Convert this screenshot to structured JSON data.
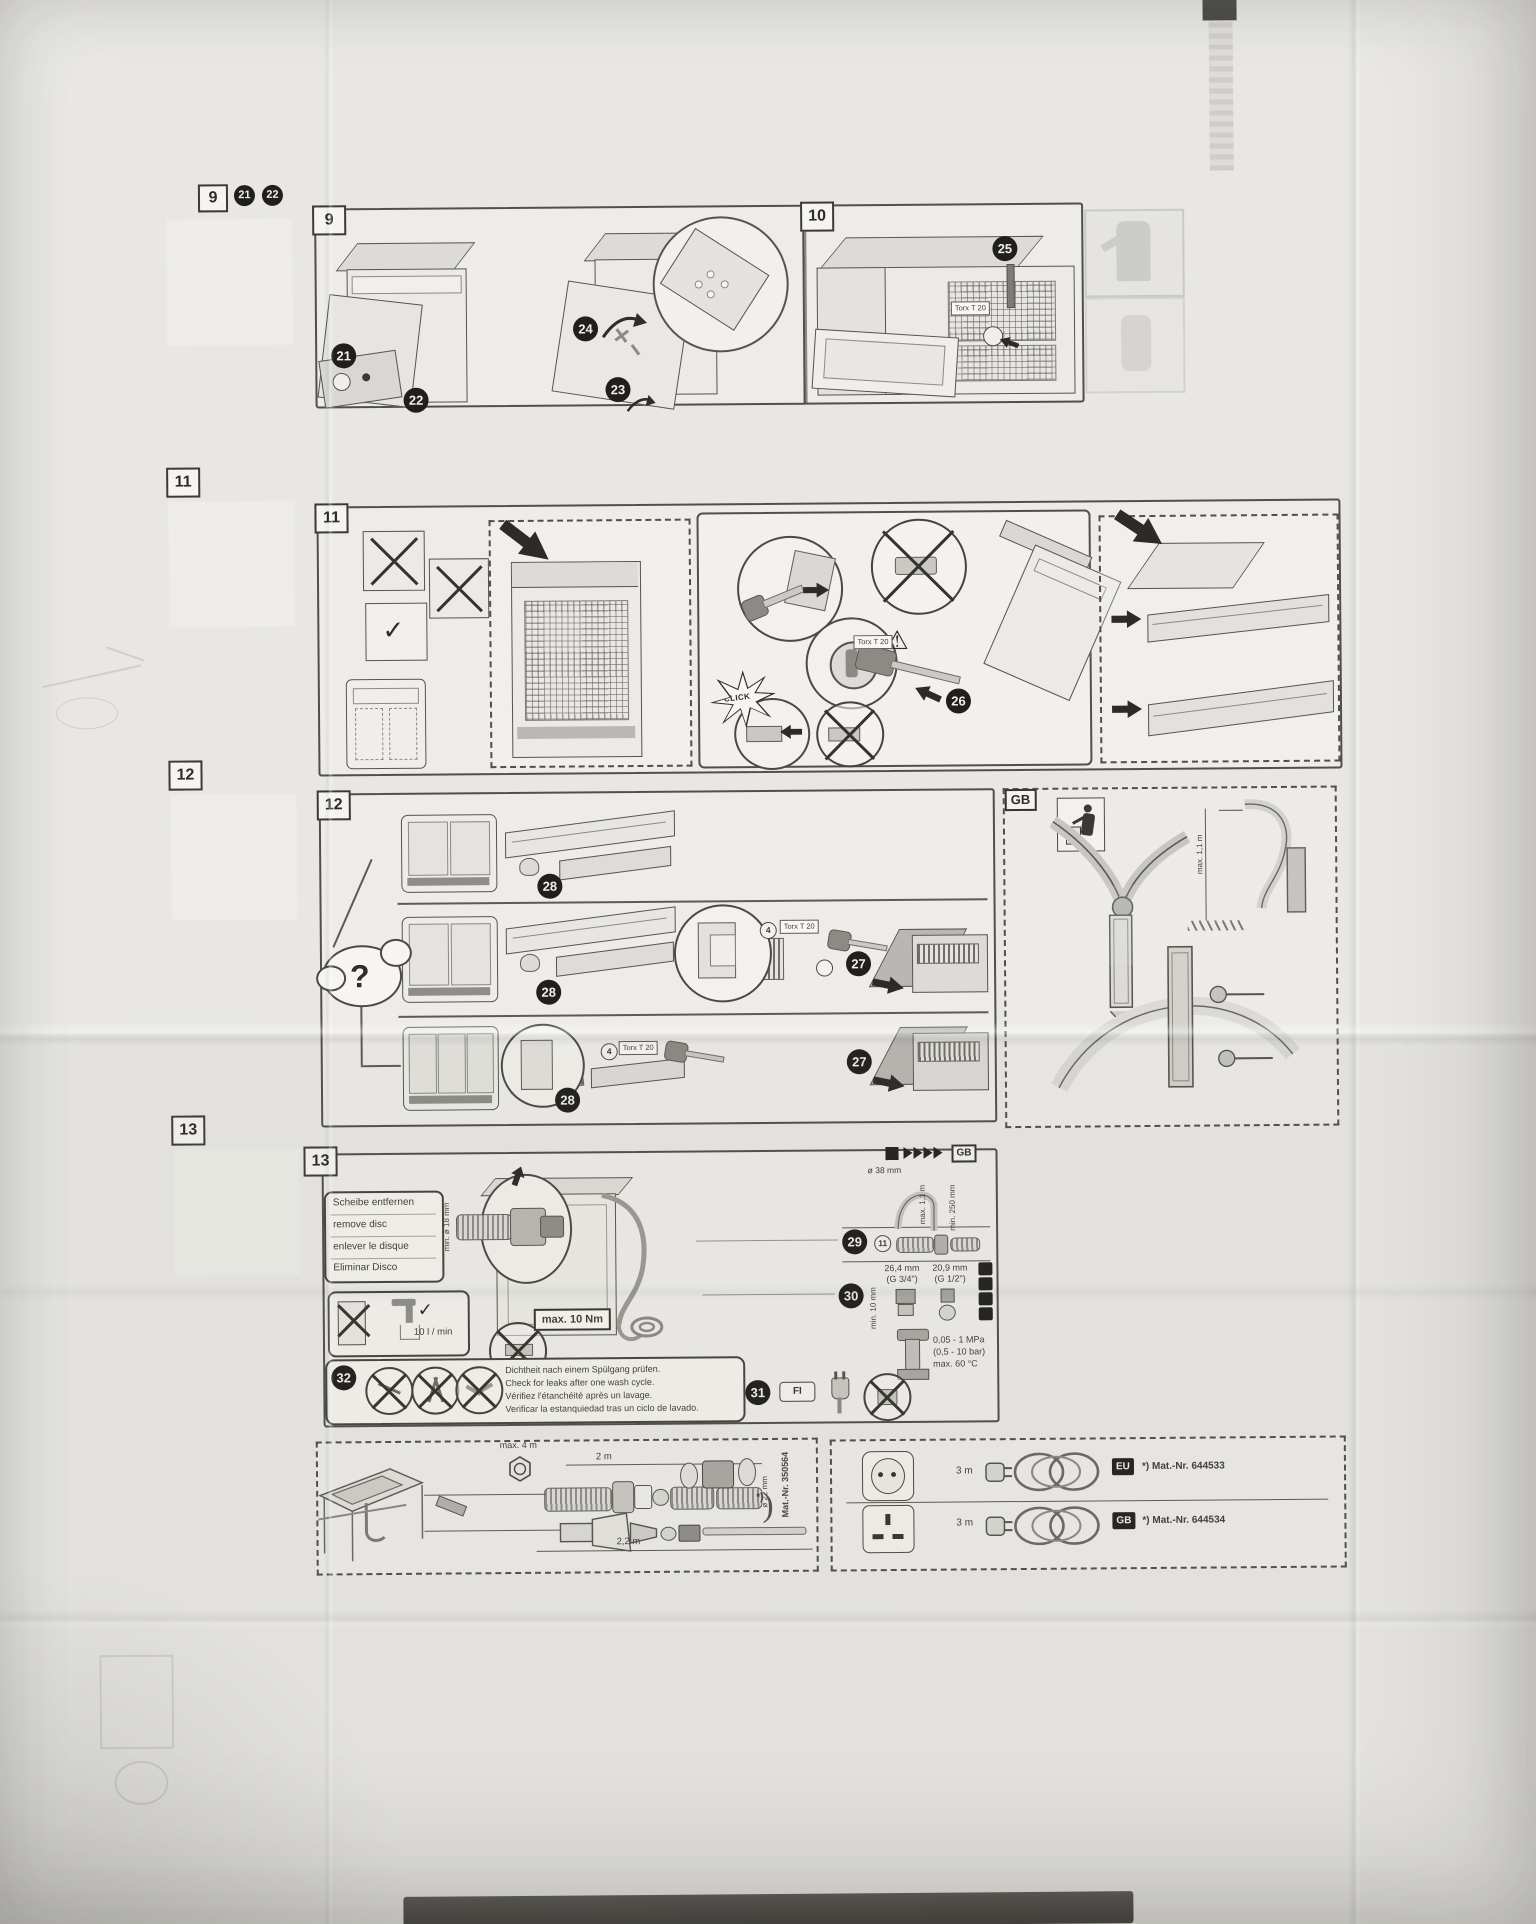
{
  "qr_column": {
    "q9": {
      "label": "9",
      "badge_a": "21",
      "badge_b": "22"
    },
    "q11": {
      "label": "11"
    },
    "q12": {
      "label": "12"
    },
    "q13": {
      "label": "13"
    }
  },
  "p9": {
    "label": "9",
    "b21": "21",
    "b22": "22",
    "b23": "23",
    "b24": "24"
  },
  "p10": {
    "label": "10",
    "b25": "25",
    "torx": "Torx T 20"
  },
  "p11": {
    "label": "11",
    "b26": "26",
    "click": "CLICK",
    "torx": "Torx T 20",
    "check": "✓",
    "warn": "!"
  },
  "p12": {
    "label": "12",
    "question": "?",
    "b27": "27",
    "b28": "28",
    "c4": "4",
    "torx": "Torx T 20"
  },
  "gb": {
    "label": "GB",
    "max_height": "max. 1,1 m"
  },
  "p13": {
    "label": "13",
    "lang1": "Scheibe entfernen",
    "lang2": "remove disc",
    "lang3": "enlever le disque",
    "lang4": "Eliminar Disco",
    "min18": "min. ø 18 mm",
    "flow": "10 l / min",
    "check": "✓",
    "torque": "max. 10 Nm",
    "gb_top": "GB",
    "d38": "ø 38 mm",
    "max_h": "max. 1,1 m",
    "min_h": "min. 250 mm",
    "b29": "29",
    "c11": "11",
    "mm264": "26,4 mm",
    "g34": "(G 3/4\")",
    "mm209": "20,9 mm",
    "g12": "(G 1/2\")",
    "b30": "30",
    "min10": "min. 10 mm",
    "mpa1": "0,05 - 1 MPa",
    "mpa2": "(0,5 - 10 bar)",
    "mpa3": "max. 60 °C",
    "b31": "31",
    "fi": "FI",
    "b32": "32",
    "leak1": "Dichtheit nach einem Spülgang prüfen.",
    "leak2": "Check for leaks after one wash cycle.",
    "leak3": "Vérifiez l'étanchéité après un lavage.",
    "leak4": "Verificar la estanquiedad tras un ciclo de lavado."
  },
  "hose": {
    "max4": "max. 4 m",
    "len2": "2 m",
    "d22": "ø 22 mm",
    "len22": "2,2 m",
    "star": "*)",
    "bracket": ")",
    "mat": "Mat.-Nr. 350564"
  },
  "plugs": {
    "r1_len": "3 m",
    "r1_tag": "EU",
    "r1_mat": "*) Mat.-Nr. 644533",
    "r2_len": "3 m",
    "r2_tag": "GB",
    "r2_mat": "*) Mat.-Nr. 644534"
  }
}
